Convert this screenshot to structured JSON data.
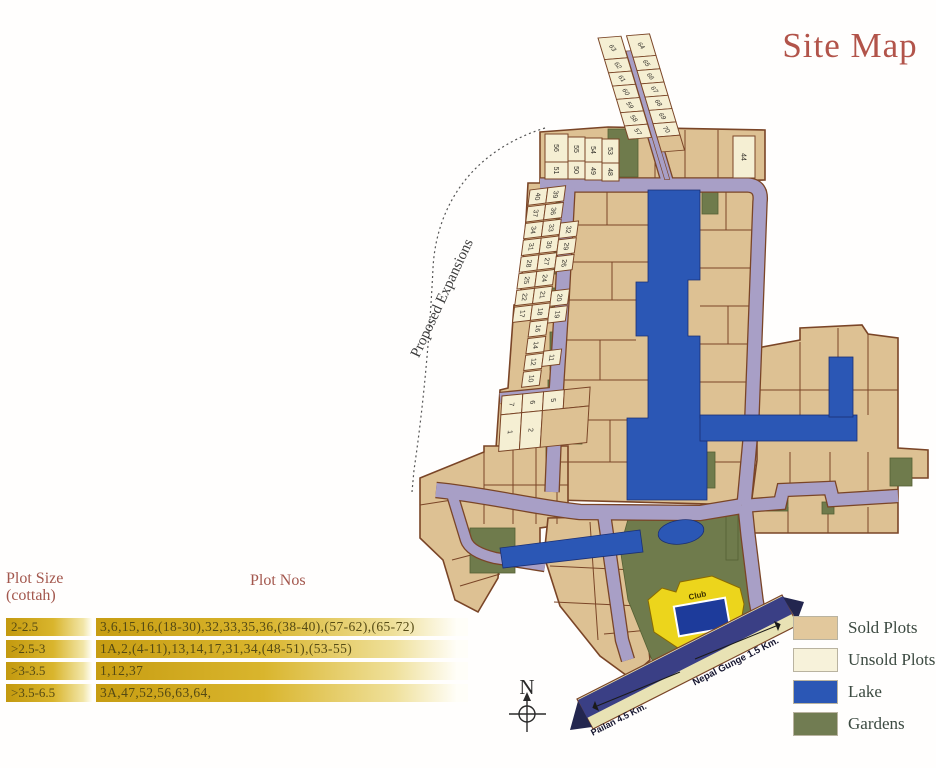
{
  "title": "Site Map",
  "title_color": "#b2544a",
  "plot_table": {
    "header_size_line1": "Plot Size",
    "header_size_line2": "(cottah)",
    "header_nos": "Plot Nos",
    "header_color": "#a3574d",
    "text_color": "#554a14",
    "rows": [
      {
        "size": "2-2.5",
        "nos": "3,6,15,16,(18-30),32,33,35,36,(38-40),(57-62),(65-72)"
      },
      {
        "size": ">2.5-3",
        "nos": "1A,2,(4-11),13,14,17,31,34,(48-51),(53-55)"
      },
      {
        "size": ">3-3.5",
        "nos": "1,12,37"
      },
      {
        "size": ">3.5-6.5",
        "nos": "3A,47,52,56,63,64,"
      }
    ]
  },
  "legend": {
    "label_color": "#3c4a41",
    "items": [
      {
        "label": "Sold Plots",
        "color": "#e2c89c"
      },
      {
        "label": "Unsold Plots",
        "color": "#f7f2da"
      },
      {
        "label": "Lake",
        "color": "#2b57b5"
      },
      {
        "label": "Gardens",
        "color": "#717c52"
      }
    ]
  },
  "compass": {
    "label": "N"
  },
  "map": {
    "colors": {
      "sold": "#ddc193",
      "unsold": "#f5efd3",
      "lake": "#2b57b5",
      "lake_edge": "#1b2f73",
      "garden": "#6f7b4c",
      "garden_edge": "#556033",
      "road": "#a89fc6",
      "border": "#7a4527",
      "club": "#ecd51c",
      "pool": "#1d3b9b",
      "band_outer": "#e8e2b4",
      "band_inner": "#3a3f85",
      "ink": "#33302a"
    },
    "labels": {
      "proposed_expansions": "Proposed Expansions",
      "club": "Club",
      "road_left": "Pailan 4.5 Km.",
      "road_right": "Nepal Gunge 1.5 Km."
    },
    "regions": [
      {
        "name": "top-block",
        "points": [
          540,
          132,
          608,
          127,
          765,
          130,
          765,
          180,
          540,
          184
        ]
      },
      {
        "name": "west-edge-block",
        "points": [
          528,
          183,
          570,
          183,
          565,
          300,
          558,
          395,
          554,
          448,
          496,
          448,
          500,
          390,
          508,
          388,
          514,
          305,
          520,
          303,
          526,
          220
        ]
      },
      {
        "name": "central-block",
        "points": [
          570,
          183,
          755,
          183,
          766,
          190,
          757,
          415,
          750,
          420,
          744,
          440,
          748,
          505,
          556,
          500,
          562,
          395,
          568,
          300
        ]
      },
      {
        "name": "east-block",
        "points": [
          757,
          348,
          800,
          340,
          800,
          328,
          862,
          325,
          868,
          334,
          898,
          338,
          898,
          448,
          928,
          450,
          928,
          478,
          898,
          478,
          898,
          533,
          742,
          533,
          742,
          500,
          752,
          498,
          757,
          460
        ]
      },
      {
        "name": "south-west-block",
        "points": [
          420,
          478,
          484,
          452,
          484,
          446,
          568,
          446,
          568,
          524,
          540,
          528,
          540,
          545,
          500,
          552,
          498,
          578,
          478,
          612,
          455,
          600,
          443,
          560,
          420,
          538
        ]
      },
      {
        "name": "south-center-block",
        "points": [
          548,
          518,
          636,
          516,
          650,
          660,
          630,
          678,
          600,
          656,
          560,
          606,
          544,
          556
        ]
      }
    ],
    "lines": [
      [
        566,
        225,
        648,
        225
      ],
      [
        565,
        262,
        648,
        262
      ],
      [
        563,
        300,
        636,
        300
      ],
      [
        561,
        340,
        636,
        340
      ],
      [
        559,
        380,
        648,
        380
      ],
      [
        557,
        420,
        627,
        420
      ],
      [
        555,
        462,
        627,
        462
      ],
      [
        607,
        185,
        607,
        225
      ],
      [
        612,
        262,
        612,
        300
      ],
      [
        600,
        340,
        600,
        380
      ],
      [
        610,
        420,
        610,
        462
      ],
      [
        700,
        230,
        753,
        230
      ],
      [
        700,
        268,
        753,
        268
      ],
      [
        700,
        306,
        752,
        306
      ],
      [
        700,
        344,
        752,
        344
      ],
      [
        700,
        382,
        751,
        382
      ],
      [
        707,
        462,
        744,
        462
      ],
      [
        726,
        185,
        726,
        230
      ],
      [
        728,
        306,
        728,
        344
      ],
      [
        757,
        390,
        829,
        390
      ],
      [
        853,
        390,
        898,
        390
      ],
      [
        790,
        452,
        790,
        494
      ],
      [
        830,
        452,
        830,
        492
      ],
      [
        868,
        452,
        868,
        490
      ],
      [
        788,
        507,
        788,
        533
      ],
      [
        828,
        507,
        828,
        533
      ],
      [
        868,
        507,
        868,
        533
      ],
      [
        800,
        342,
        800,
        415
      ],
      [
        868,
        334,
        868,
        415
      ],
      [
        838,
        328,
        838,
        357
      ],
      [
        513,
        446,
        513,
        524
      ],
      [
        536,
        446,
        536,
        524
      ],
      [
        557,
        446,
        557,
        524
      ],
      [
        484,
        485,
        568,
        485
      ],
      [
        484,
        452,
        484,
        524
      ],
      [
        590,
        522,
        598,
        640
      ],
      [
        550,
        566,
        634,
        570
      ],
      [
        554,
        602,
        638,
        606
      ],
      [
        604,
        634,
        650,
        630
      ],
      [
        655,
        132,
        655,
        180
      ],
      [
        685,
        130,
        685,
        180
      ],
      [
        718,
        130,
        718,
        180
      ],
      [
        452,
        560,
        498,
        548
      ],
      [
        460,
        586,
        500,
        574
      ],
      [
        420,
        505,
        452,
        500
      ]
    ],
    "gardens": [
      {
        "rect": [
          608,
          129,
          30,
          48
        ]
      },
      {
        "rect": [
          702,
          188,
          16,
          26
        ]
      },
      {
        "rect": [
          556,
          202,
          11,
          24
        ]
      },
      {
        "rect": [
          554,
          246,
          11,
          28
        ]
      },
      {
        "rect": [
          552,
          288,
          11,
          30
        ]
      },
      {
        "rect": [
          550,
          332,
          11,
          38
        ]
      },
      {
        "rect": [
          548,
          380,
          11,
          34
        ]
      },
      {
        "rect": [
          546,
          426,
          12,
          40
        ]
      },
      {
        "rect": [
          568,
          392,
          14,
          52
        ]
      },
      {
        "poly": [
          630,
          512,
          742,
          512,
          752,
          598,
          757,
          622,
          700,
          668,
          652,
          660,
          628,
          600,
          620,
          548
        ]
      },
      {
        "rect": [
          752,
          500,
          36,
          11
        ]
      },
      {
        "rect": [
          890,
          458,
          22,
          28
        ]
      },
      {
        "rect": [
          822,
          502,
          12,
          12
        ]
      },
      {
        "rect": [
          726,
          510,
          12,
          50
        ]
      },
      {
        "rect": [
          470,
          528,
          45,
          45
        ]
      },
      {
        "rect": [
          706,
          452,
          9,
          36
        ]
      }
    ],
    "roads": [
      {
        "d": "M540,185 L748,185 Q762,186 760,202 L752,415",
        "w": 13
      },
      {
        "d": "M750,440 L744,505",
        "w": 13
      },
      {
        "d": "M568,188 L562,300 L556,395 L552,492",
        "w": 13
      },
      {
        "d": "M436,490 C480,494 540,508 580,512 L700,513 L742,506",
        "w": 14
      },
      {
        "d": "M742,506 L780,503 L783,490 L830,488 L833,500 L898,496",
        "w": 12
      },
      {
        "d": "M745,506 L748,535 L756,600 L760,622",
        "w": 13
      },
      {
        "d": "M604,514 L612,570 L622,640 L628,660",
        "w": 12
      },
      {
        "d": "M452,494 L466,540 Q470,552 495,558 L545,566",
        "w": 10
      },
      {
        "d": "M500,398 L563,392",
        "w": 10
      },
      {
        "d": "M652,130 L668,184",
        "w": 11
      }
    ],
    "lakes": [
      {
        "poly": [
          648,
          190,
          700,
          190,
          700,
          280,
          688,
          280,
          688,
          336,
          700,
          336,
          700,
          418,
          707,
          418,
          707,
          500,
          627,
          500,
          627,
          418,
          648,
          418,
          648,
          336,
          636,
          336,
          636,
          282,
          648,
          282
        ]
      },
      {
        "rect": [
          700,
          415,
          157,
          26
        ]
      },
      {
        "rect": [
          829,
          357,
          24,
          60
        ]
      },
      {
        "poly": [
          500,
          548,
          640,
          530,
          643,
          552,
          503,
          568
        ]
      },
      {
        "ellipse": [
          681,
          532,
          23,
          12,
          -8
        ]
      }
    ],
    "plot_groups": [
      {
        "name": "north-strip",
        "transform": "matrix(1,-0.08,0.25,0.83,598,38)",
        "road": [
          23.5,
          18,
          5,
          155
        ],
        "label_rot": 70,
        "plots": [
          [
            0,
            0,
            23,
            26,
            "63"
          ],
          [
            0,
            26,
            23,
            16,
            "62"
          ],
          [
            0,
            42,
            23,
            16,
            "61"
          ],
          [
            0,
            58,
            23,
            16,
            "60"
          ],
          [
            0,
            74,
            23,
            16,
            "59"
          ],
          [
            0,
            90,
            23,
            16,
            "58"
          ],
          [
            0,
            106,
            23,
            16,
            "57"
          ],
          [
            28.5,
            0,
            23,
            26,
            "64"
          ],
          [
            28.5,
            26,
            23,
            16,
            "65"
          ],
          [
            28.5,
            42,
            23,
            16,
            "66"
          ],
          [
            28.5,
            58,
            23,
            16,
            "67"
          ],
          [
            28.5,
            74,
            23,
            16,
            "68"
          ],
          [
            28.5,
            90,
            23,
            16,
            "69"
          ],
          [
            28.5,
            106,
            23,
            16,
            "70"
          ],
          [
            28.5,
            122,
            23,
            18,
            "",
            "sold"
          ]
        ]
      },
      {
        "name": "west-strip",
        "transform": "matrix(0.99,-0.12,-0.13,0.985,530,190)",
        "label_rot": 92,
        "plots": [
          [
            0,
            0,
            18,
            15.5,
            "40"
          ],
          [
            18,
            0,
            18,
            15.5,
            "39"
          ],
          [
            0,
            17,
            18,
            15.5,
            "37"
          ],
          [
            18,
            17,
            18,
            15.5,
            "36"
          ],
          [
            0,
            34,
            18,
            15.5,
            "34"
          ],
          [
            18,
            34,
            18,
            15.5,
            "33"
          ],
          [
            36,
            38,
            18,
            15.5,
            "32"
          ],
          [
            0,
            51,
            18,
            15.5,
            "31"
          ],
          [
            18,
            51,
            18,
            15.5,
            "30"
          ],
          [
            36,
            55,
            18,
            15.5,
            "29"
          ],
          [
            0,
            68,
            18,
            15.5,
            "28"
          ],
          [
            18,
            68,
            18,
            15.5,
            "27"
          ],
          [
            36,
            72,
            18,
            15.5,
            "26"
          ],
          [
            0,
            85,
            18,
            15.5,
            "25"
          ],
          [
            18,
            85,
            18,
            15.5,
            "24"
          ],
          [
            0,
            102,
            18,
            15.5,
            "22"
          ],
          [
            18,
            102,
            18,
            15.5,
            "21"
          ],
          [
            36,
            107,
            18,
            15.5,
            "20"
          ],
          [
            0,
            119,
            18,
            15.5,
            "17"
          ],
          [
            18,
            119,
            18,
            15.5,
            "18"
          ],
          [
            36,
            124,
            18,
            15.5,
            "19"
          ],
          [
            18,
            136,
            18,
            15.5,
            "16"
          ],
          [
            18,
            153,
            18,
            15.5,
            "14"
          ],
          [
            18,
            170,
            18,
            15.5,
            "12"
          ],
          [
            36,
            168,
            18,
            15.5,
            "11"
          ],
          [
            18,
            187,
            18,
            15.5,
            "10"
          ]
        ]
      },
      {
        "name": "south-west-small-block",
        "transform": "matrix(0.99,-0.1,-0.06,0.99,502,396)",
        "label_rot": 92,
        "plots": [
          [
            0,
            0,
            21,
            19,
            "7"
          ],
          [
            21,
            0,
            21,
            19,
            "6"
          ],
          [
            42,
            0,
            21,
            19,
            "5"
          ],
          [
            63,
            0,
            26,
            19,
            "",
            "sold"
          ],
          [
            0,
            19,
            21,
            37,
            "1"
          ],
          [
            21,
            19,
            21,
            37,
            "2"
          ],
          [
            42,
            19,
            47,
            37,
            "",
            "sold"
          ]
        ]
      }
    ],
    "plots": [
      [
        545,
        134,
        23,
        28,
        "56"
      ],
      [
        568,
        137,
        17,
        24,
        "55"
      ],
      [
        585,
        138,
        17,
        24,
        "54"
      ],
      [
        602,
        139,
        17,
        24,
        "53"
      ],
      [
        545,
        162,
        23,
        17,
        "51"
      ],
      [
        568,
        161,
        17,
        18,
        "50"
      ],
      [
        585,
        162,
        17,
        18,
        "49"
      ],
      [
        602,
        163,
        17,
        18,
        "48"
      ],
      [
        733,
        136,
        22,
        42,
        "44"
      ]
    ],
    "club": {
      "poly": [
        648,
        600,
        662,
        588,
        676,
        592,
        680,
        582,
        712,
        576,
        740,
        588,
        744,
        604,
        738,
        640,
        710,
        652,
        678,
        648,
        654,
        632
      ],
      "pool": [
        676,
        602,
        52,
        30,
        -10
      ],
      "label_pos": [
        698,
        598
      ],
      "label_rot": -12
    },
    "band": {
      "outer": [
        577,
        699,
        782,
        595,
        798,
        625,
        593,
        729
      ],
      "inner": [
        578,
        700,
        783,
        596,
        792,
        614,
        587,
        718
      ],
      "tips": [
        [
          578,
          701,
          592,
          727,
          570,
          730
        ],
        [
          783,
          597,
          797,
          621,
          804,
          602
        ]
      ],
      "arrows": [
        {
          "x1": 597,
          "y1": 706,
          "x2": 680,
          "y2": 672,
          "head": "start"
        },
        {
          "x1": 695,
          "y1": 659,
          "x2": 776,
          "y2": 626,
          "head": "end"
        }
      ],
      "label_left_pos": [
        620,
        722
      ],
      "label_right_pos": [
        737,
        664
      ],
      "label_rot": -27
    },
    "expansion": {
      "path": "M545,128 C468,152 436,210 433,268 C430,330 424,402 414,470 L412,492",
      "text_pos": [
        446,
        300
      ],
      "text_rot": -65
    },
    "compass": {
      "n_pos": [
        527,
        694
      ],
      "lines": [
        [
          527,
          698,
          527,
          732
        ],
        [
          509,
          714,
          546,
          714
        ]
      ],
      "circle": [
        527,
        714,
        8
      ],
      "arrow": [
        523,
        701,
        527,
        692,
        531,
        701
      ]
    }
  }
}
